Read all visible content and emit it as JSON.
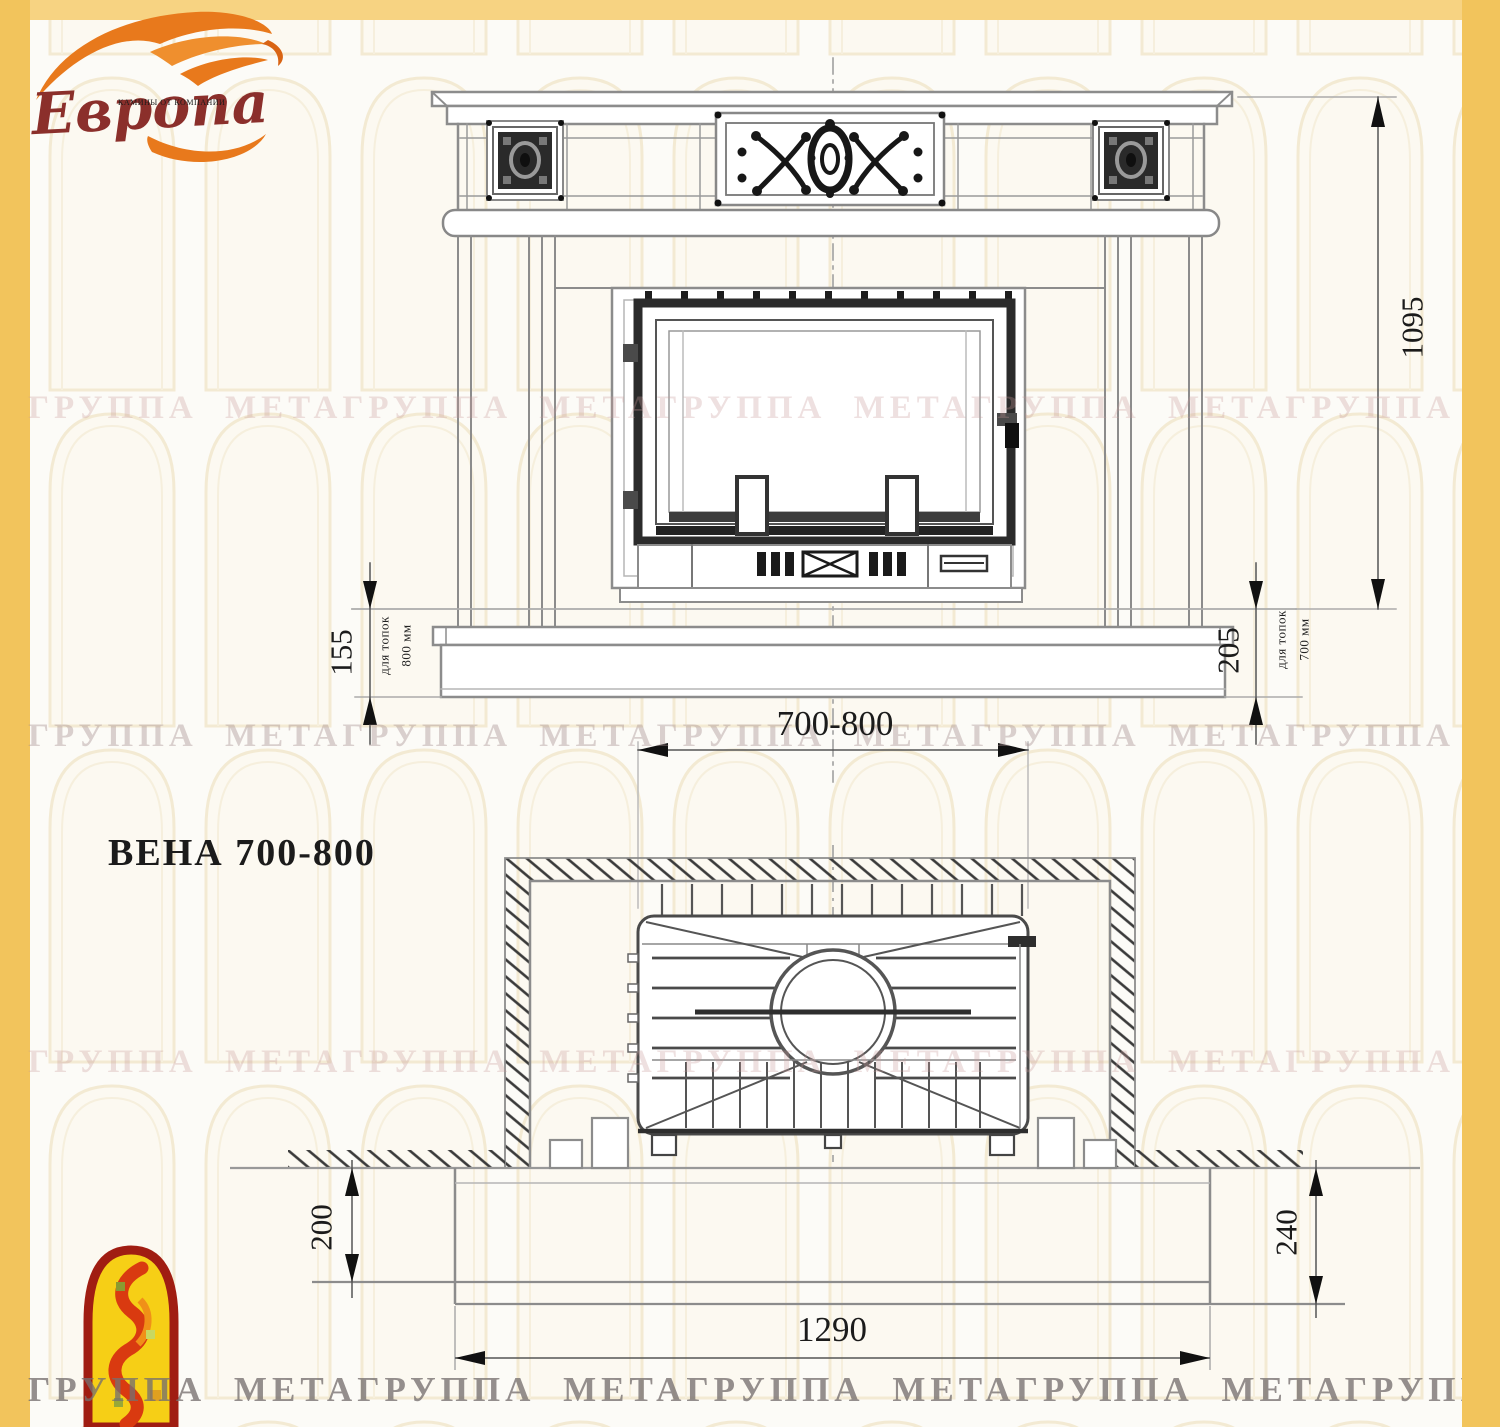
{
  "brand": {
    "name": "Европа",
    "tagline": "КАМИНЫ ОТ КОМПАНИИ"
  },
  "title": "ВЕНА 700-800",
  "front_view": {
    "height_mm": "1095",
    "firebox_width_mm": "700-800",
    "base_left": {
      "height_mm": "155",
      "note_line1": "для топок",
      "note_line2": "800 мм"
    },
    "base_right": {
      "height_mm": "205",
      "note_line1": "для топок",
      "note_line2": "700 мм"
    }
  },
  "plan_view": {
    "width_mm": "1290",
    "hearth_left_depth_mm": "200",
    "hearth_right_depth_mm": "240"
  },
  "watermark": {
    "band_text": "ГРУППА МЕТАГРУППА МЕТАГРУППА МЕТАГРУППА МЕТАГРУППА МЕТАГРУППА МЕТА"
  },
  "colors": {
    "frame_yellow": "#f2c45c",
    "flame_orange": "#e8791c",
    "brand_maroon": "#8b2f2b",
    "line_gray": "#8c8c8c",
    "ink": "#1c1c1c"
  }
}
